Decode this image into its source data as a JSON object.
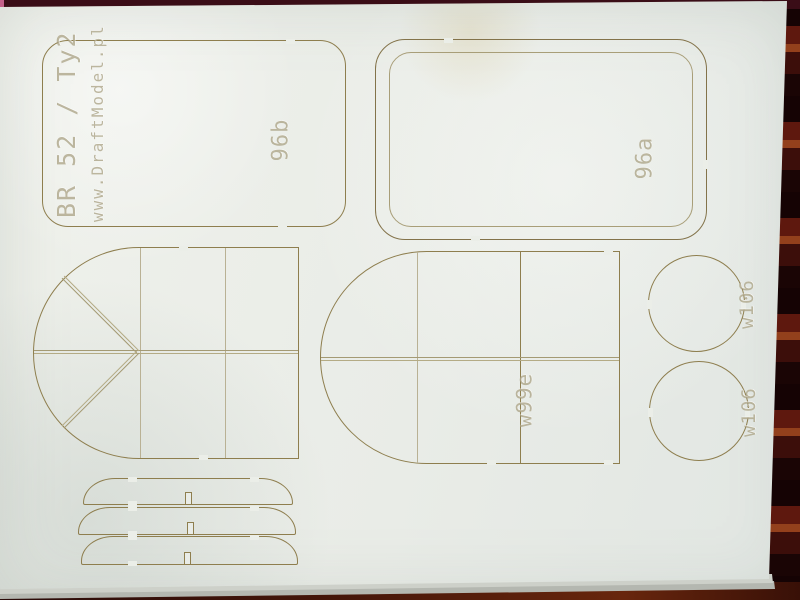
{
  "sheet": {
    "brand": {
      "title": "BR 52 / Ty2",
      "website": "www.DraftModel.pl"
    },
    "parts": {
      "panel_b": {
        "label": "96b"
      },
      "panel_a": {
        "label": "96a"
      },
      "fan_arch": {
        "label": ""
      },
      "arch": {
        "label": "w99e"
      },
      "disc_top": {
        "label": "w106"
      },
      "disc_bottom": {
        "label": "w106"
      }
    },
    "colors": {
      "paper": "#e9ece7",
      "cut_line": "#8e7e4e",
      "engrave_line": "#a89e78",
      "engraved_text": "#948a66",
      "background_fabric": "#2c0d0e",
      "pink_edge": "#c4608a",
      "under_sheet": "#cdd0c9"
    }
  }
}
